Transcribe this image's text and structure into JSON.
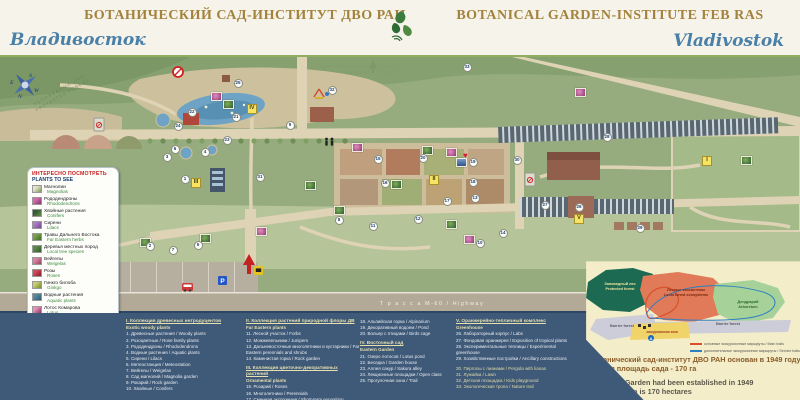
{
  "header": {
    "title_ru": "БОТАНИЧЕСКИЙ САД-ИНСТИТУТ ДВО РАН",
    "title_en": "BOTANICAL GARDEN-INSTITUTE FEB RAS",
    "city_ru": "Владивосток",
    "city_en": "Vladivostok"
  },
  "plants_to_see": {
    "title_ru": "ИНТЕРЕСНО ПОСМОТРЕТЬ",
    "title_en": "PLANTS TO SEE",
    "items": [
      {
        "ru": "Магнолии",
        "en": "Magnolias"
      },
      {
        "ru": "Рододендроны",
        "en": "Rhododendrons"
      },
      {
        "ru": "Хвойные растения",
        "en": "Conifers"
      },
      {
        "ru": "Сирени",
        "en": "Lilacs"
      },
      {
        "ru": "Травы Дальнего Востока",
        "en": "Far Eastern herbs"
      },
      {
        "ru": "Деревья местных пород",
        "en": "Local tree species"
      },
      {
        "ru": "Вейгелы",
        "en": "Weigelas"
      },
      {
        "ru": "Розы",
        "en": "Roses"
      },
      {
        "ru": "Гинкго билоба",
        "en": "Ginkgo"
      },
      {
        "ru": "Водные растения",
        "en": "Aquatic plants"
      },
      {
        "ru": "Лотос Комарова",
        "en": "Lotus"
      }
    ]
  },
  "facilities": {
    "items": [
      {
        "icon": "info-icon",
        "ru": "Информация",
        "en": "Info plate"
      },
      {
        "icon": "atm-icon",
        "ru": "Банкомат",
        "en": "ATM"
      },
      {
        "icon": "parking-icon",
        "ru": "Парковка",
        "en": "Parking"
      },
      {
        "icon": "bus-icon",
        "ru": "Остановка транспорта",
        "en": "Bus stop"
      },
      {
        "icon": "toilet-icon",
        "ru": "Туалет",
        "en": "Toilet"
      },
      {
        "icon": "playground-icon",
        "ru": "Детская площадка",
        "en": "Playground for kids"
      },
      {
        "icon": "heart-icon",
        "ru": "Мост любви",
        "en": "Lovers bridge"
      }
    ]
  },
  "legend": {
    "columns": [
      {
        "entries": [
          {
            "h": "I. Коллекция древесных интродуцентов",
            "en": "Exotic woody plants"
          },
          {
            "t": "1. Древесные растения / Woody plants"
          },
          {
            "t": "2. Розоцветные / Rose family plants"
          },
          {
            "t": "3. Рододендроны / Rhododendrons"
          },
          {
            "t": "4. Водные растения / Aquatic plants"
          },
          {
            "t": "5. Сирени / Lilacs"
          },
          {
            "t": "6. Метеостанция / Meteostation"
          },
          {
            "t": "7. Вейгелы / Weigelas"
          },
          {
            "t": "8. Сад магнолий / Magnolia garden"
          },
          {
            "t": "9. Рокарий / Rock garden"
          },
          {
            "t": "10. Хвойные / Conifers"
          }
        ]
      },
      {
        "entries": [
          {
            "h": "II. Коллекция растений природной флоры ДВ",
            "en": "Far Eastern plants"
          },
          {
            "t": "11. Лесной участок / Forbs"
          },
          {
            "t": "12. Можжевельники / Junipers"
          },
          {
            "t": "13. Дальневосточные многолетники и кустарники / Far Eastern perennials and shrubs"
          },
          {
            "t": "14. Каменистая горка / Rock garden"
          },
          {
            "h": "III. Коллекция цветочно-декоративных растений",
            "en": "Ornamental plants",
            "gap": true
          },
          {
            "t": "15. Розарий / Roses"
          },
          {
            "t": "16. Многолетники / Perennials"
          },
          {
            "t": "17. Сменная экспозиция / Short-term exposition"
          }
        ]
      },
      {
        "entries": [
          {
            "t": "18. Альпийская горка / Alpinarium"
          },
          {
            "t": "19. Декоративный водоем / Pond"
          },
          {
            "t": "20. Вольер с птицами / Birds cage"
          },
          {
            "h": "IV. Восточный сад",
            "en": "Eastern Garden",
            "gap": true
          },
          {
            "t": "21. Озеро лотосов / Lotus pond"
          },
          {
            "t": "22. Беседка / Garden house"
          },
          {
            "t": "23. Аллея сакур / Sakura alley"
          },
          {
            "t": "24. Лекционные площадки / Open class"
          },
          {
            "t": "25. Прогулочная зона / Trail"
          }
        ]
      },
      {
        "entries": [
          {
            "h": "V. Оранжерейно-тепличный комплекс",
            "en": "Greenhouse"
          },
          {
            "t": "26. Лабораторный корпус / Labs"
          },
          {
            "t": "27. Фондовая оранжерея / Exposition of tropical plants"
          },
          {
            "t": "28. Экспериментальные теплицы / Experimental greenhouse"
          },
          {
            "t": "29. Хозяйственные постройки / Ancillary constructions"
          },
          {
            "t": "30. Перголы с лианами / Pergola with lianas",
            "m": true,
            "gap": true
          },
          {
            "t": "31. Лужайка / Lawn",
            "m": true
          },
          {
            "t": "32. Детская площадка / Kids playground",
            "m": true
          },
          {
            "t": "33. Экологическая тропа / Nature trail",
            "m": true
          }
        ]
      }
    ]
  },
  "map": {
    "labels": {
      "highway": "Т р а с с а   М-60  /  Highway",
      "eco_left_ru": "ЭКОЛОГИЧЕСКАЯ",
      "eco_left_en": "NATURE",
      "eco_right_ru": "ТРОПА",
      "eco_right_en": "TRAIL",
      "protected_ru": "ЗАПОВЕДНЫЙ ЛЕС",
      "protected_en": "PROTECTED FOREST",
      "compass": {
        "n": "N",
        "e": "E",
        "s": "S",
        "w": "W"
      },
      "parking_p": "P",
      "bus_a": "A"
    },
    "markers": [
      {
        "n": "1",
        "x": 185,
        "y": 179
      },
      {
        "n": "2",
        "x": 150,
        "y": 246
      },
      {
        "n": "3",
        "x": 167,
        "y": 157
      },
      {
        "n": "4",
        "x": 205,
        "y": 152
      },
      {
        "n": "5",
        "x": 198,
        "y": 245
      },
      {
        "n": "6",
        "x": 175,
        "y": 149
      },
      {
        "n": "7",
        "x": 173,
        "y": 250
      },
      {
        "n": "8",
        "x": 339,
        "y": 220
      },
      {
        "n": "9",
        "x": 290,
        "y": 125
      },
      {
        "n": "10",
        "x": 480,
        "y": 243
      },
      {
        "n": "11",
        "x": 373,
        "y": 226
      },
      {
        "n": "12",
        "x": 418,
        "y": 219
      },
      {
        "n": "13",
        "x": 475,
        "y": 198
      },
      {
        "n": "14",
        "x": 503,
        "y": 233
      },
      {
        "n": "15",
        "x": 378,
        "y": 159
      },
      {
        "n": "16",
        "x": 385,
        "y": 183
      },
      {
        "n": "17",
        "x": 447,
        "y": 201
      },
      {
        "n": "18",
        "x": 473,
        "y": 182
      },
      {
        "n": "19",
        "x": 473,
        "y": 162
      },
      {
        "n": "20",
        "x": 423,
        "y": 158
      },
      {
        "n": "21",
        "x": 236,
        "y": 117
      },
      {
        "n": "22",
        "x": 192,
        "y": 112
      },
      {
        "n": "23",
        "x": 227,
        "y": 140
      },
      {
        "n": "24",
        "x": 178,
        "y": 126
      },
      {
        "n": "25",
        "x": 238,
        "y": 83
      },
      {
        "n": "26",
        "x": 579,
        "y": 207
      },
      {
        "n": "27",
        "x": 545,
        "y": 205
      },
      {
        "n": "28",
        "x": 607,
        "y": 137
      },
      {
        "n": "29",
        "x": 640,
        "y": 228
      },
      {
        "n": "30",
        "x": 517,
        "y": 160
      },
      {
        "n": "31",
        "x": 260,
        "y": 177
      },
      {
        "n": "32",
        "x": 332,
        "y": 90
      },
      {
        "n": "33",
        "x": 467,
        "y": 67
      }
    ],
    "romans": [
      {
        "n": "I",
        "x": 707,
        "y": 161
      },
      {
        "n": "II",
        "x": 434,
        "y": 180
      },
      {
        "n": "III",
        "x": 196,
        "y": 183
      },
      {
        "n": "IV",
        "x": 252,
        "y": 109
      },
      {
        "n": "V",
        "x": 579,
        "y": 219
      }
    ],
    "thumbs": [
      {
        "x": 216,
        "y": 96,
        "t": "p"
      },
      {
        "x": 228,
        "y": 104,
        "t": "g"
      },
      {
        "x": 357,
        "y": 147,
        "t": "p"
      },
      {
        "x": 427,
        "y": 150,
        "t": "g"
      },
      {
        "x": 451,
        "y": 152,
        "t": "p"
      },
      {
        "x": 461,
        "y": 162,
        "t": "b"
      },
      {
        "x": 396,
        "y": 184,
        "t": "g"
      },
      {
        "x": 339,
        "y": 210,
        "t": "g"
      },
      {
        "x": 451,
        "y": 224,
        "t": "g"
      },
      {
        "x": 469,
        "y": 239,
        "t": "p"
      },
      {
        "x": 145,
        "y": 242,
        "t": "g"
      },
      {
        "x": 205,
        "y": 238,
        "t": "g"
      },
      {
        "x": 261,
        "y": 231,
        "t": "p"
      },
      {
        "x": 310,
        "y": 185,
        "t": "g"
      },
      {
        "x": 580,
        "y": 92,
        "t": "p"
      },
      {
        "x": 746,
        "y": 160,
        "t": "g"
      }
    ]
  },
  "inset": {
    "zones": [
      {
        "ru": "Заповедный лес",
        "en": "Protected forest",
        "color": "#1d6a53"
      },
      {
        "ru": "Лесные экосистемы",
        "en": "Local forest ecosystems",
        "color": "#e07a58"
      },
      {
        "ru": "Дендрарий",
        "en": "Arboretum",
        "color": "#a6d29a"
      },
      {
        "ru": "Барьерный лес",
        "en": "Barrier forest",
        "color": "#cdccd9"
      },
      {
        "ru": "Экскурсионная зона",
        "en": "",
        "color": "#f0d469"
      }
    ],
    "labels": [
      {
        "x": 42,
        "y": 22,
        "lines": [
          "Заповедный лес",
          "Protected forest"
        ],
        "color": "#efe3a0",
        "size": 3.8
      },
      {
        "x": 108,
        "y": 28,
        "lines": [
          "Лесные экосистемы",
          "Local forest ecosystems"
        ],
        "color": "#7a2410",
        "size": 3.8
      },
      {
        "x": 170,
        "y": 40,
        "lines": [
          "Дендрарий",
          "Arboretum"
        ],
        "color": "#2f6b2f",
        "size": 3.8
      },
      {
        "x": 44,
        "y": 64,
        "lines": [
          "Barrier forest"
        ],
        "color": "#5a5a66",
        "size": 3.8
      },
      {
        "x": 150,
        "y": 62,
        "lines": [
          "Barrier forest"
        ],
        "color": "#5a5a66",
        "size": 3.8
      },
      {
        "x": 84,
        "y": 71,
        "lines": [
          "экскурсионная зона"
        ],
        "color": "#a33a22",
        "size": 3.2
      }
    ],
    "trails": [
      {
        "color": "#d94f2b",
        "label": "основные экскурсионные маршруты / Main trails"
      },
      {
        "color": "#2f7fc1",
        "label": "дополнительные экскурсионные маршруты / Service trails"
      }
    ],
    "founded": {
      "ru1": "Ботанический сад-институт ДВО РАН основан в 1949 году",
      "ru2": "Общая площадь сада - 170 га",
      "en1": "Botanical Garden had been established in 1949",
      "en2": "The total area is 170 hectares"
    }
  }
}
